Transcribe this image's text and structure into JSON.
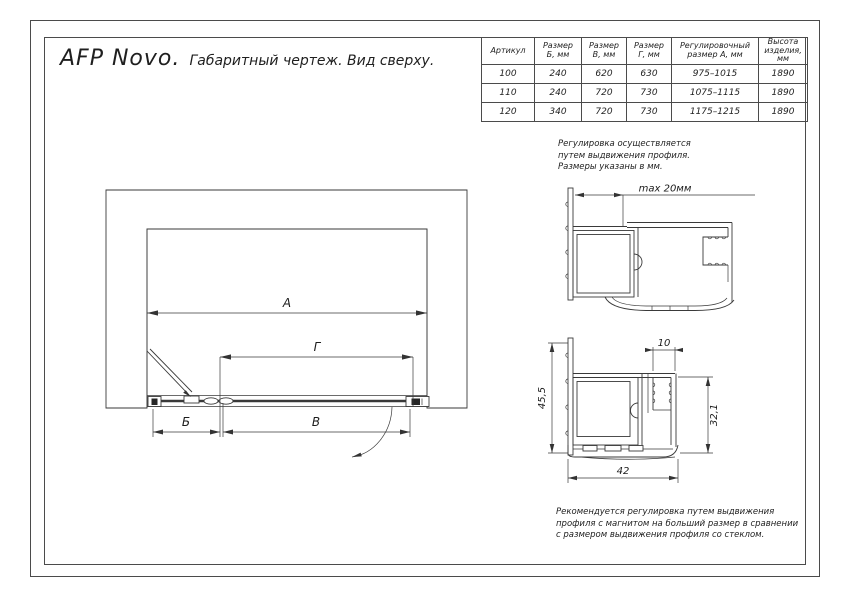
{
  "title": {
    "product": "AFP Novo.",
    "caption": "Габаритный чертеж. Вид сверху."
  },
  "table": {
    "headers": [
      {
        "lines": [
          "Артикул"
        ]
      },
      {
        "lines": [
          "Размер",
          "Б, мм"
        ]
      },
      {
        "lines": [
          "Размер",
          "В, мм"
        ]
      },
      {
        "lines": [
          "Размер",
          "Г, мм"
        ]
      },
      {
        "lines": [
          "Регулировочный",
          "размер А, мм"
        ]
      },
      {
        "lines": [
          "Высота",
          "изделия,",
          "мм"
        ]
      }
    ],
    "rows": [
      [
        "100",
        "240",
        "620",
        "630",
        "975–1015",
        "1890"
      ],
      [
        "110",
        "240",
        "720",
        "730",
        "1075–1115",
        "1890"
      ],
      [
        "120",
        "340",
        "720",
        "730",
        "1175–1215",
        "1890"
      ]
    ]
  },
  "notes": {
    "adjustment": {
      "lines": [
        "Регулировка осуществляется",
        "путем выдвижения профиля.",
        "Размеры указаны в мм."
      ]
    },
    "recommendation": {
      "lines": [
        "Рекомендуется регулировка путем выдвижения",
        "профиля с магнитом на больший размер в сравнении",
        "с размером выдвижения профиля со стеклом."
      ]
    }
  },
  "plan": {
    "dim_a": "А",
    "dim_g": "Г",
    "dim_b": "Б",
    "dim_v": "В"
  },
  "profiles": {
    "top": {
      "max_dim": "max 20мм"
    },
    "bottom": {
      "height": "45,5",
      "slot_width": "10",
      "inner_height": "32,1",
      "base_width": "42"
    }
  },
  "colors": {
    "ink": "#3a3a3a",
    "paper": "#ffffff"
  }
}
